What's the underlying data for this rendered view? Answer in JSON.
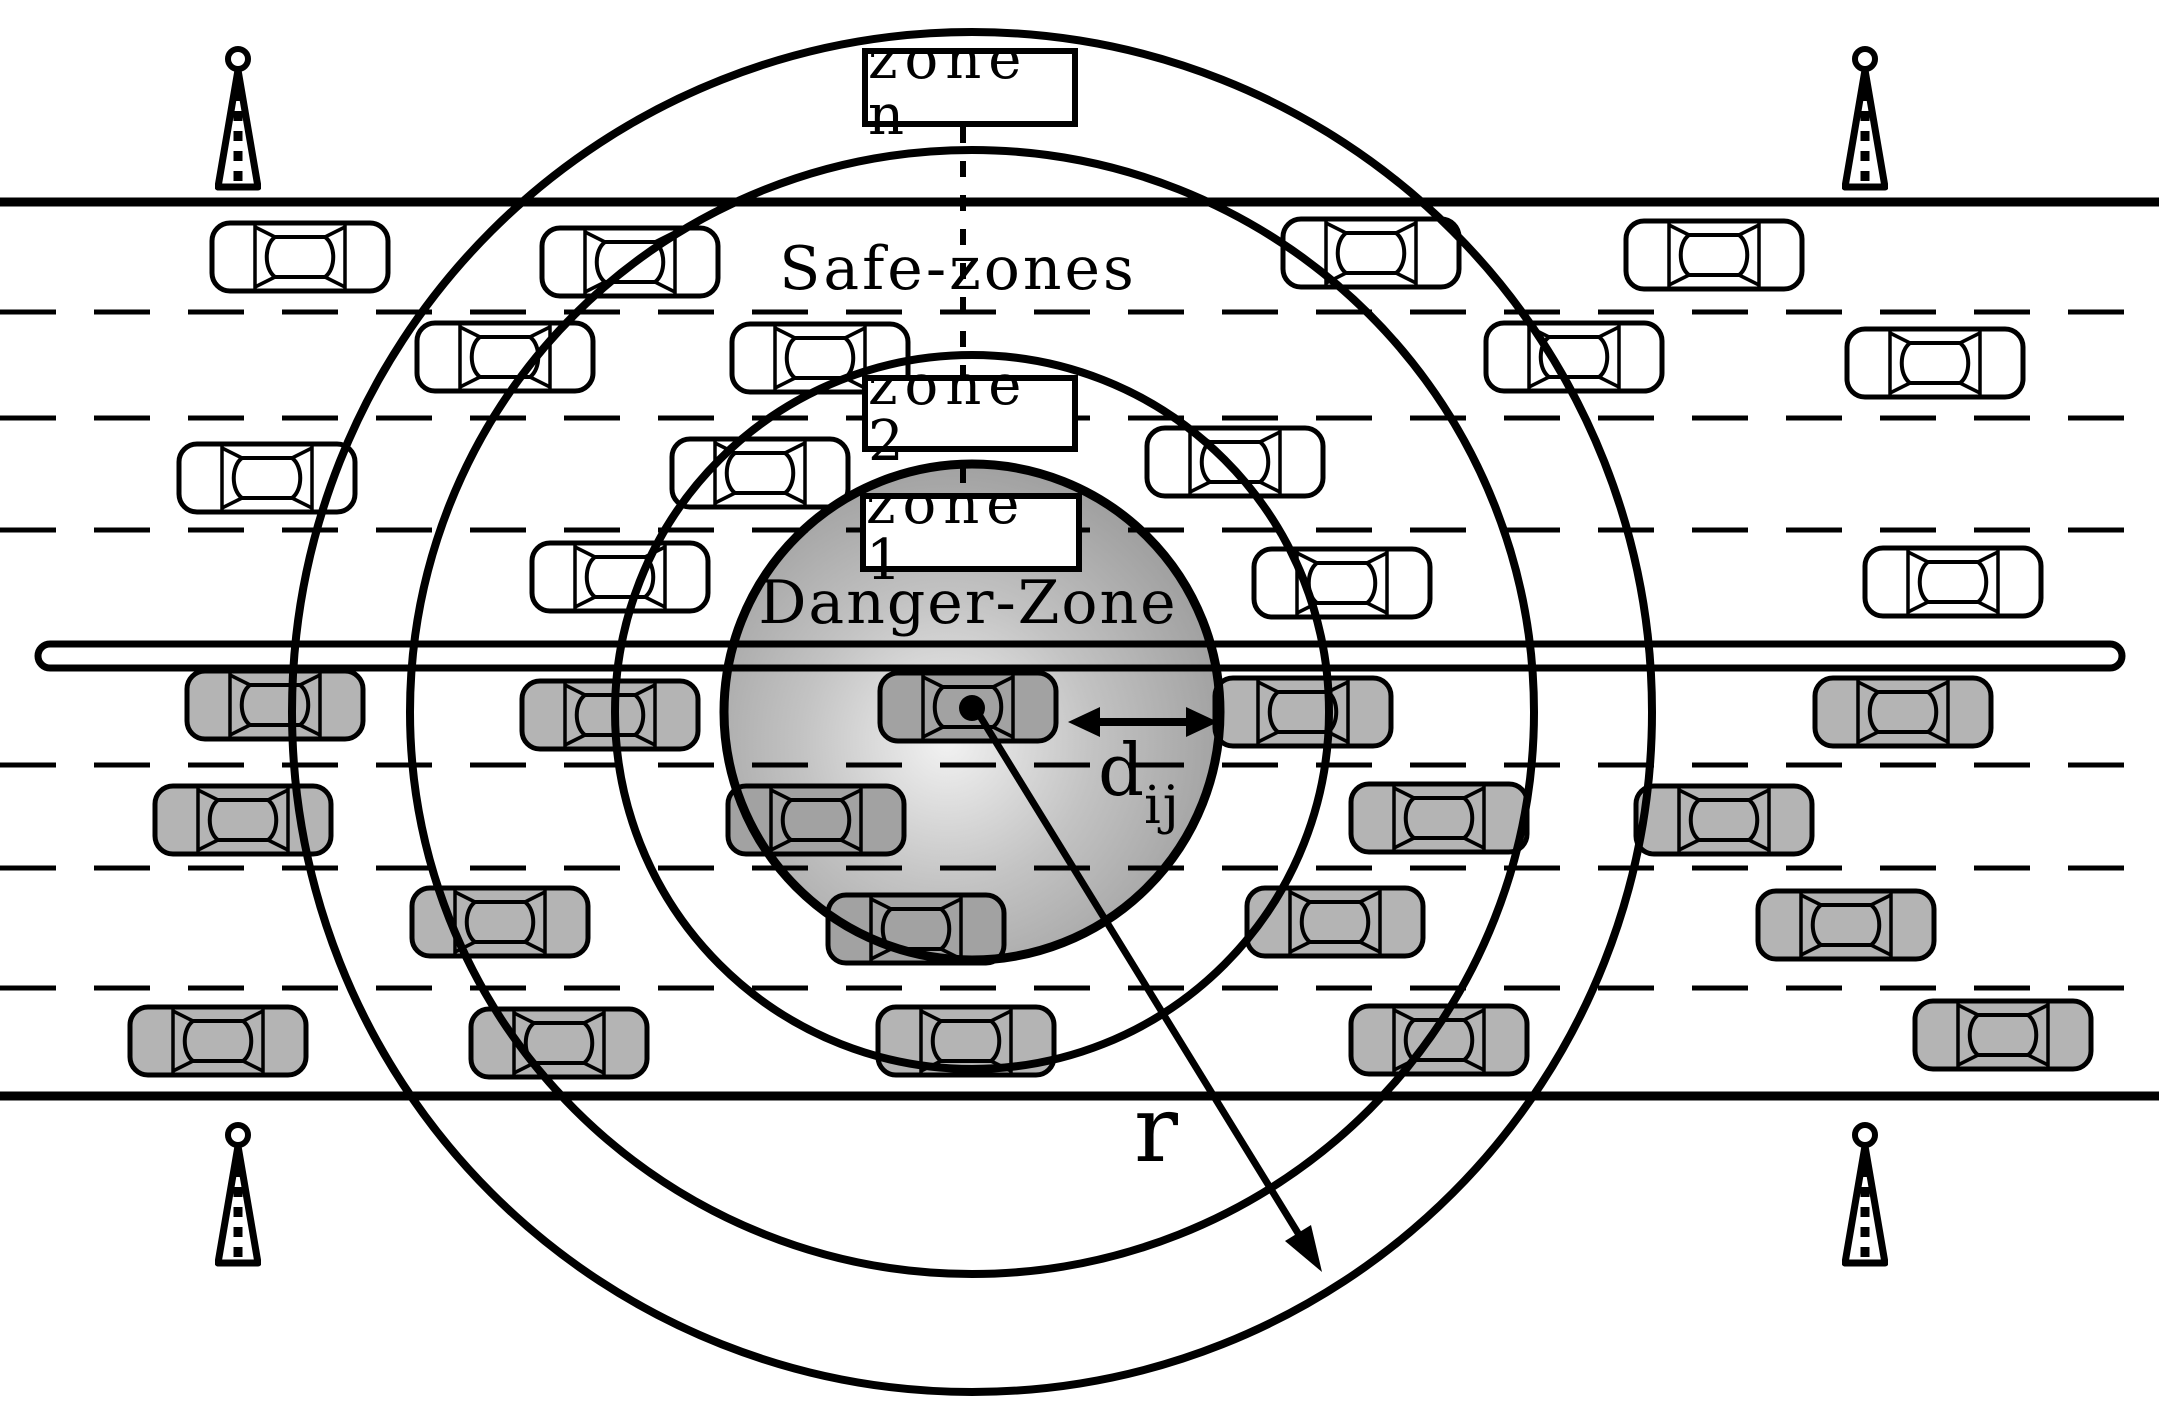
{
  "figure": {
    "title": "vehicular-network zone diagram",
    "labels": {
      "zone_n": "zone n",
      "zone_2": "zone 2",
      "zone_1": "zone 1",
      "safe_zones": "Safe-zones",
      "danger_zone": "Danger-Zone",
      "radius": "r",
      "distance_base": "d",
      "distance_sub": "ij"
    },
    "colors": {
      "line": "#000000",
      "car_white": "#ffffff",
      "car_gray": "#b4b4b4",
      "car_danger": "#a2a2a2",
      "danger_gradient_inner": "#f2f2f2",
      "danger_gradient_mid": "#c3c3c3",
      "danger_gradient_outer": "#969696"
    },
    "diagram": {
      "width": 2159,
      "height": 1425,
      "road": {
        "top_edge_y": 202,
        "bottom_edge_y": 1096,
        "median": {
          "x": 38,
          "y": 644,
          "w": 2084,
          "h": 24
        },
        "lane_divider_ys": [
          312,
          418,
          530,
          765,
          868,
          988
        ],
        "dash_pattern": "56 38"
      },
      "circles": {
        "cx": 972,
        "cy": 712,
        "danger_radius": 248,
        "zone_radii": [
          357,
          562,
          680
        ]
      },
      "center_dot": {
        "x": 972,
        "y": 708,
        "r": 13
      },
      "guide_dash_line": {
        "x": 963,
        "y1": 127,
        "y2": 493
      },
      "r_arrow": {
        "x1": 975,
        "y1": 708,
        "x2": 1301,
        "y2": 1238,
        "head": "1322,1272 1311,1225 1285,1241"
      },
      "d_arrow": {
        "x1": 1078,
        "x2": 1208,
        "y": 722,
        "left_head": "1068,722 1100,707 1100,737",
        "right_head": "1218,722 1186,707 1186,737"
      },
      "cars": {
        "white": [
          [
            300,
            257
          ],
          [
            630,
            262
          ],
          [
            1371,
            253
          ],
          [
            1714,
            255
          ],
          [
            505,
            357
          ],
          [
            820,
            358
          ],
          [
            1574,
            357
          ],
          [
            1935,
            363
          ],
          [
            267,
            478
          ],
          [
            760,
            473
          ],
          [
            1235,
            462
          ],
          [
            620,
            577
          ],
          [
            1342,
            583
          ],
          [
            1953,
            582
          ]
        ],
        "gray": [
          [
            275,
            705
          ],
          [
            610,
            715
          ],
          [
            1303,
            712
          ],
          [
            1903,
            712
          ],
          [
            243,
            820
          ],
          [
            1439,
            818
          ],
          [
            1724,
            820
          ],
          [
            500,
            922
          ],
          [
            1335,
            922
          ],
          [
            1846,
            925
          ],
          [
            218,
            1041
          ],
          [
            559,
            1043
          ],
          [
            966,
            1041
          ],
          [
            1439,
            1040
          ],
          [
            2003,
            1035
          ]
        ],
        "danger": [
          [
            968,
            707
          ],
          [
            816,
            820
          ],
          [
            916,
            929
          ]
        ]
      },
      "antennas": [
        [
          238,
          46
        ],
        [
          1865,
          46
        ],
        [
          238,
          1122
        ],
        [
          1865,
          1122
        ]
      ]
    }
  }
}
